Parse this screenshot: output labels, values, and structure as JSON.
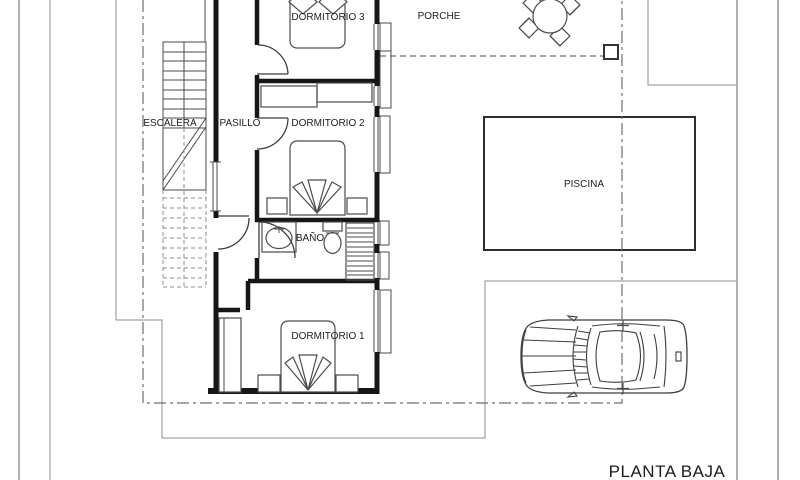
{
  "drawing_type": "architectural floor plan",
  "title": "PLANTA BAJA",
  "labels": {
    "dormitorio3": "DORMITORIO 3",
    "dormitorio2": "DORMITORIO 2",
    "dormitorio1": "DORMITORIO 1",
    "pasillo": "PASILLO",
    "escalera": "ESCALERA",
    "bano": "BAÑO",
    "porche": "PORCHE",
    "piscina": "PISCINA",
    "planta_baja": "PLANTA BAJA"
  },
  "plan_elements": [
    "stairs-with-section-cut",
    "corridor",
    "three-bedrooms-with-double-beds-and-nightstands",
    "bathroom-with-sink-wc-and-shower",
    "built-in-closets",
    "wardrobe",
    "porch-round-table-with-four-chairs",
    "porch-column",
    "swimming-pool",
    "car-top-view",
    "parcel-boundary-dash-dot-lines",
    "site-limit-lines"
  ],
  "colors": {
    "background": "#ffffff",
    "wall": "#161616",
    "line": "#4b4b4b",
    "site": "#8d8d8d",
    "boundary": "#6f6f6f",
    "text": "#1c1c1c"
  }
}
